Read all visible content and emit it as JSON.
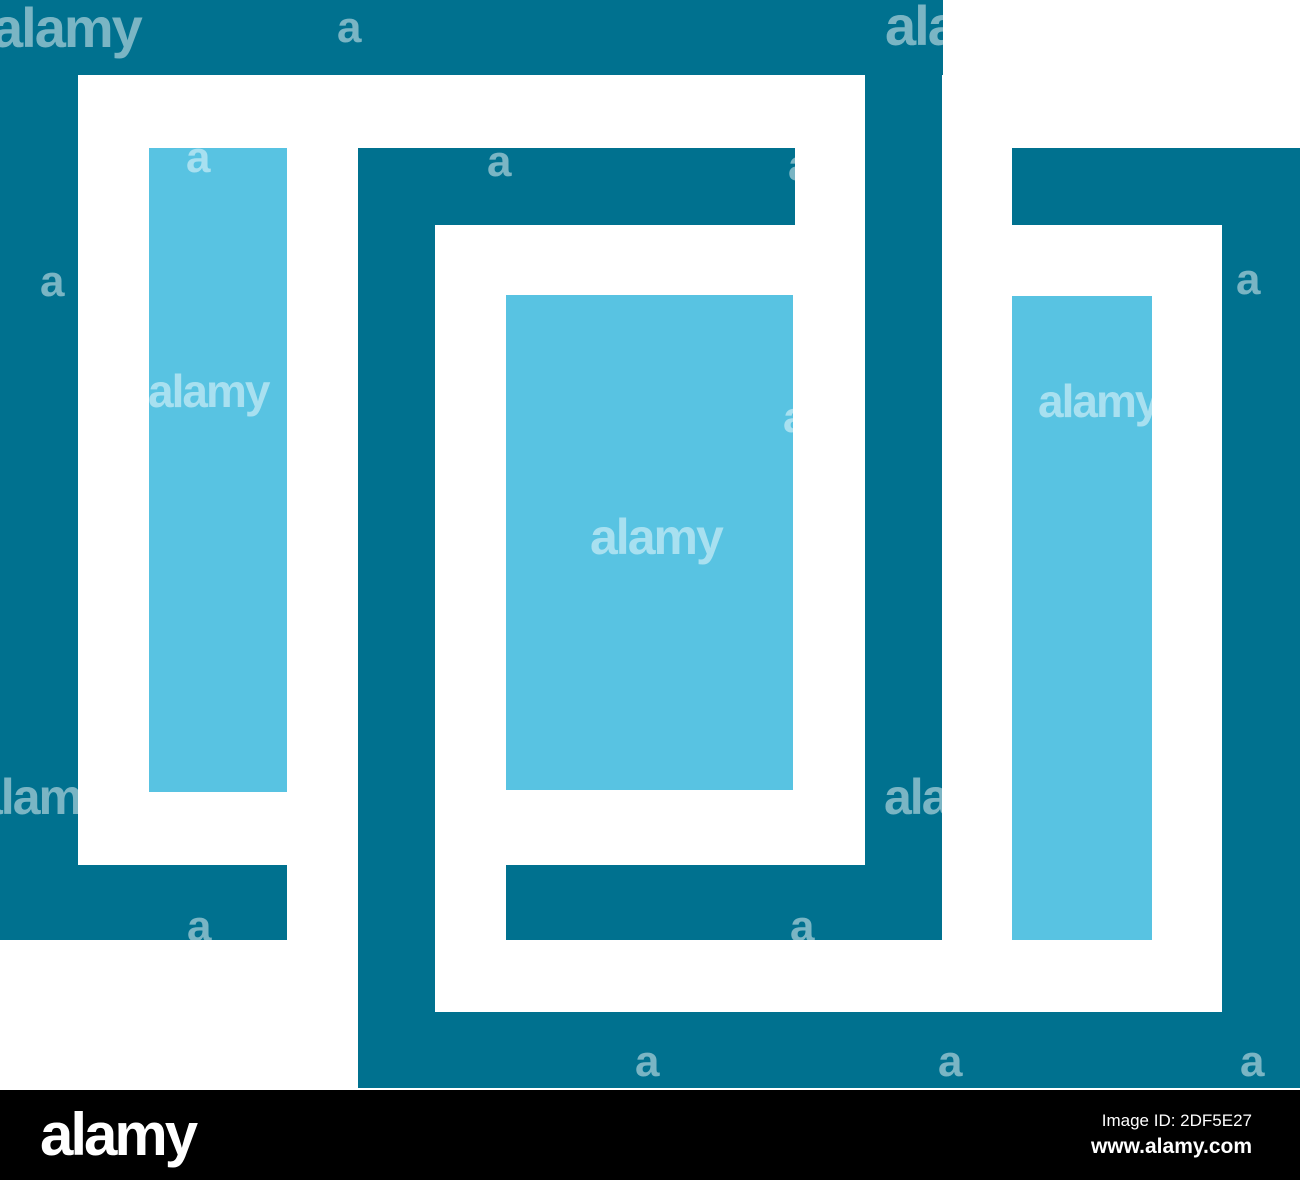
{
  "artwork": {
    "description": "abstract-interlocking-rectangles-logo",
    "background": "#ffffff",
    "colors": {
      "teal": "#00718F",
      "lightblue": "#58C3E2",
      "watermark": "rgba(255,255,255,0.48)"
    },
    "shapes": [
      {
        "name": "outer-frame-top-band",
        "color": "teal",
        "x": 0,
        "y": 0,
        "w": 943,
        "h": 75
      },
      {
        "name": "outer-frame-left-band",
        "color": "teal",
        "x": 0,
        "y": 0,
        "w": 78,
        "h": 940
      },
      {
        "name": "outer-frame-bottom-left-band",
        "color": "teal",
        "x": 0,
        "y": 865,
        "w": 287,
        "h": 75
      },
      {
        "name": "outer-frame-right-band",
        "color": "teal",
        "x": 865,
        "y": 0,
        "w": 77,
        "h": 865
      },
      {
        "name": "outer-frame-inner-bottom-band",
        "color": "teal",
        "x": 506,
        "y": 865,
        "w": 436,
        "h": 75
      },
      {
        "name": "middle-frame-left-band",
        "color": "teal",
        "x": 358,
        "y": 148,
        "w": 77,
        "h": 940
      },
      {
        "name": "middle-frame-top-band",
        "color": "teal",
        "x": 358,
        "y": 148,
        "w": 437,
        "h": 77
      },
      {
        "name": "bottom-band",
        "color": "teal",
        "x": 358,
        "y": 1012,
        "w": 942,
        "h": 76
      },
      {
        "name": "right-frame-top-band",
        "color": "teal",
        "x": 1012,
        "y": 148,
        "w": 288,
        "h": 77
      },
      {
        "name": "right-frame-right-band",
        "color": "teal",
        "x": 1222,
        "y": 148,
        "w": 78,
        "h": 940
      },
      {
        "name": "left-lightblue-bar",
        "color": "lightblue",
        "x": 149,
        "y": 148,
        "w": 138,
        "h": 644
      },
      {
        "name": "middle-lightblue-rect",
        "color": "lightblue",
        "x": 506,
        "y": 295,
        "w": 287,
        "h": 495
      },
      {
        "name": "right-lightblue-bar",
        "color": "lightblue",
        "x": 1012,
        "y": 296,
        "w": 140,
        "h": 644
      }
    ],
    "watermarks": [
      {
        "text": "alamy",
        "x": -8,
        "y": 0,
        "size": 56
      },
      {
        "text": "a",
        "x": 337,
        "y": 6,
        "size": 44
      },
      {
        "text": "ala",
        "x": 885,
        "y": -2,
        "size": 56
      },
      {
        "text": "a",
        "x": 186,
        "y": 136,
        "size": 44
      },
      {
        "text": "a",
        "x": 487,
        "y": 140,
        "size": 44
      },
      {
        "text": "a",
        "x": 788,
        "y": 144,
        "size": 44
      },
      {
        "text": "a",
        "x": 40,
        "y": 260,
        "size": 44
      },
      {
        "text": "a",
        "x": 1236,
        "y": 258,
        "size": 44
      },
      {
        "text": "alamy",
        "x": 148,
        "y": 368,
        "size": 46
      },
      {
        "text": "alamy",
        "x": 1038,
        "y": 378,
        "size": 46
      },
      {
        "text": "a",
        "x": 783,
        "y": 396,
        "size": 44
      },
      {
        "text": "alamy",
        "x": 590,
        "y": 512,
        "size": 50
      },
      {
        "text": "alamy",
        "x": -25,
        "y": 772,
        "size": 50
      },
      {
        "text": "ala",
        "x": 884,
        "y": 772,
        "size": 50
      },
      {
        "text": "a",
        "x": 187,
        "y": 905,
        "size": 44
      },
      {
        "text": "a",
        "x": 790,
        "y": 905,
        "size": 44
      },
      {
        "text": "a",
        "x": 635,
        "y": 1040,
        "size": 44
      },
      {
        "text": "a",
        "x": 938,
        "y": 1040,
        "size": 44
      },
      {
        "text": "a",
        "x": 1240,
        "y": 1040,
        "size": 44
      }
    ]
  },
  "footer": {
    "brand": "alamy",
    "image_id_label": "Image ID: 2DF5E27",
    "url": "www.alamy.com",
    "background": "#000000",
    "text_color": "#ffffff"
  }
}
